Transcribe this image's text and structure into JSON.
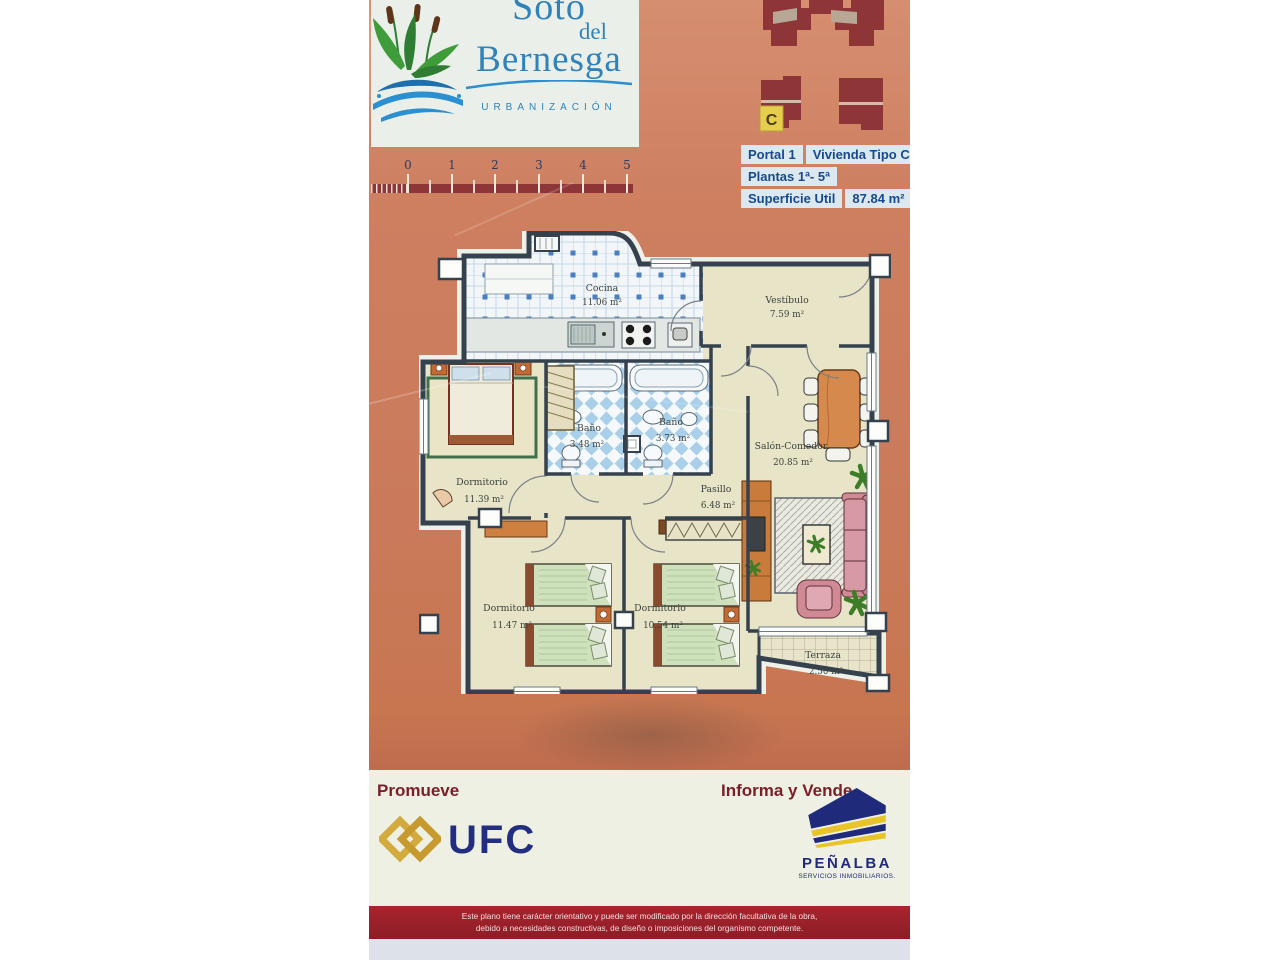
{
  "logo": {
    "line1": "Soto",
    "line2": "del",
    "line3": "Bernesga",
    "subtitle": "URBANIZACIÓN"
  },
  "site_plan": {
    "unit_label": "C"
  },
  "info_panel": {
    "portal": "Portal 1",
    "vivienda": "Vivienda Tipo C",
    "plantas": "Plantas 1ª- 5ª",
    "superficie_label": "Superficie Util",
    "superficie_value": "87.84 m²"
  },
  "scale_bar": {
    "ticks": [
      "0",
      "1",
      "2",
      "3",
      "4",
      "5"
    ]
  },
  "floor_plan": {
    "rooms": [
      {
        "name": "Cocina",
        "area": "11.06 m²"
      },
      {
        "name": "Vestíbulo",
        "area": "7.59 m²"
      },
      {
        "name": "Baño",
        "area": "3.48 m²"
      },
      {
        "name": "Baño",
        "area": "3.73 m²"
      },
      {
        "name": "Dormitorio",
        "area": "11.39 m²"
      },
      {
        "name": "Pasillo",
        "area": "6.48 m²"
      },
      {
        "name": "Salón-Comedor",
        "area": "20.85 m²"
      },
      {
        "name": "Dormitorio",
        "area": "11.47 m²"
      },
      {
        "name": "Dormitorio",
        "area": "10.54 m²"
      },
      {
        "name": "Terraza",
        "area": "2.50 m²"
      }
    ]
  },
  "footer": {
    "promueve_label": "Promueve",
    "promoter_name": "UFC",
    "informa_label": "Informa y Vende",
    "seller_name": "PEÑALBA",
    "seller_subtitle": "SERVICIOS INMOBILIARIOS.",
    "disclaimer_line1": "Este plano tiene carácter orientativo y puede ser modificado por la dirección facultativa de la obra,",
    "disclaimer_line2": "debido a necesidades constructivas, de diseño o imposiciones del organismo competente."
  },
  "colors": {
    "background_orange": "#ca7a5a",
    "brochure_maroon": "#8e3538",
    "logo_blue": "#2f82ba",
    "info_text_blue": "#164a8c",
    "ufc_navy": "#232e80",
    "ufc_gold": "#d3aa3e",
    "penalba_navy": "#202a7a",
    "penalba_yellow": "#e8c428",
    "unit_marker_yellow": "#e7cd4e"
  }
}
